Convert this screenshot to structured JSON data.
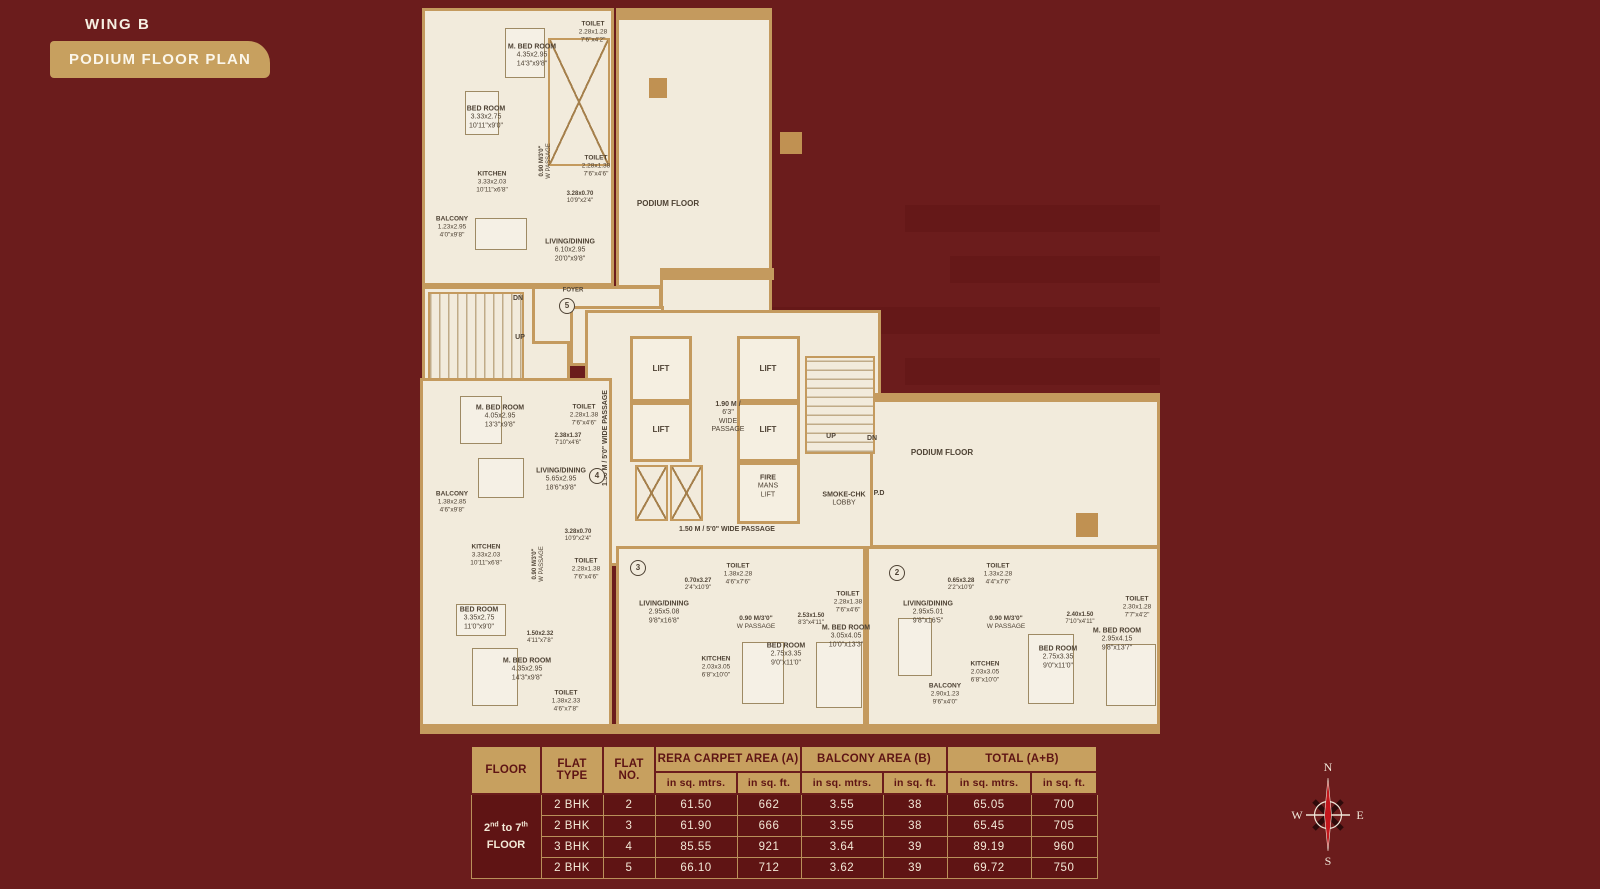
{
  "header": {
    "wing": "WING B",
    "badge": "PODIUM FLOOR PLAN"
  },
  "plan": {
    "labels": [
      {
        "id": "t5_toilet1",
        "lines": [
          "TOILET",
          "2.28x1.28",
          "7'6\"x4'2\""
        ]
      },
      {
        "id": "t5_mbed",
        "lines": [
          "M. BED ROOM",
          "4.35x2.95",
          "14'3\"x9'8\""
        ]
      },
      {
        "id": "t5_bed",
        "lines": [
          "BED ROOM",
          "3.33x2.75",
          "10'11\"x9'0\""
        ]
      },
      {
        "id": "t5_pass",
        "lines": [
          "0.90 M/3'0\"",
          "W PASSAGE"
        ]
      },
      {
        "id": "t5_toilet2",
        "lines": [
          "TOILET",
          "2.28x1.38",
          "7'6\"x4'6\""
        ]
      },
      {
        "id": "t5_kitchen",
        "lines": [
          "KITCHEN",
          "3.33x2.03",
          "10'11\"x6'8\""
        ]
      },
      {
        "id": "t5_dim1",
        "lines": [
          "3.28x0.70",
          "10'9\"x2'4\""
        ]
      },
      {
        "id": "t5_balcony",
        "lines": [
          "BALCONY",
          "1.23x2.95",
          "4'0\"x9'8\""
        ]
      },
      {
        "id": "t5_living",
        "lines": [
          "LIVING/DINING",
          "6.10x2.95",
          "20'0\"x9'8\""
        ]
      },
      {
        "id": "podium_top",
        "lines": [
          "PODIUM FLOOR"
        ]
      },
      {
        "id": "dn1",
        "lines": [
          "DN"
        ]
      },
      {
        "id": "up1",
        "lines": [
          "UP"
        ]
      },
      {
        "id": "foyer",
        "lines": [
          "FOYER"
        ]
      },
      {
        "id": "circ5",
        "circle": true,
        "lines": [
          "5"
        ]
      },
      {
        "id": "lift1",
        "lines": [
          "LIFT"
        ]
      },
      {
        "id": "lift2",
        "lines": [
          "LIFT"
        ]
      },
      {
        "id": "lift3",
        "lines": [
          "LIFT"
        ]
      },
      {
        "id": "lift4",
        "lines": [
          "LIFT"
        ]
      },
      {
        "id": "pass190",
        "lines": [
          "1.90 M /",
          "6'3\"",
          "WIDE",
          "PASSAGE"
        ]
      },
      {
        "id": "fire",
        "lines": [
          "FIRE",
          "MANS",
          "LIFT"
        ]
      },
      {
        "id": "smoke",
        "lines": [
          "SMOKE-CHK",
          "LOBBY"
        ]
      },
      {
        "id": "pd",
        "lines": [
          "P.D"
        ]
      },
      {
        "id": "up2",
        "lines": [
          "UP"
        ]
      },
      {
        "id": "dn2",
        "lines": [
          "DN"
        ]
      },
      {
        "id": "vpass",
        "lines": [
          "1.50 M / 5'0\"  WIDE PASSAGE"
        ]
      },
      {
        "id": "hpass",
        "lines": [
          "1.50 M / 5'0\"  WIDE PASSAGE"
        ]
      },
      {
        "id": "f4_mbed",
        "lines": [
          "M. BED ROOM",
          "4.05x2.95",
          "13'3\"x9'8\""
        ]
      },
      {
        "id": "f4_toilet1",
        "lines": [
          "TOILET",
          "2.28x1.38",
          "7'6\"x4'6\""
        ]
      },
      {
        "id": "f4_dim1",
        "lines": [
          "2.38x1.37",
          "7'10\"x4'6\""
        ]
      },
      {
        "id": "f4_living",
        "lines": [
          "LIVING/DINING",
          "5.65x2.95",
          "18'6\"x9'8\""
        ]
      },
      {
        "id": "f4_balcony",
        "lines": [
          "BALCONY",
          "1.38x2.85",
          "4'6\"x9'8\""
        ]
      },
      {
        "id": "circ4",
        "circle": true,
        "lines": [
          "4"
        ]
      },
      {
        "id": "f4_dim2",
        "lines": [
          "3.28x0.70",
          "10'9\"x2'4\""
        ]
      },
      {
        "id": "f4_kitchen",
        "lines": [
          "KITCHEN",
          "3.33x2.03",
          "10'11\"x6'8\""
        ]
      },
      {
        "id": "f4_pass",
        "lines": [
          "0.90 M/3'0\"",
          "W PASSAGE"
        ]
      },
      {
        "id": "f4_toilet2",
        "lines": [
          "TOILET",
          "2.28x1.38",
          "7'6\"x4'6\""
        ]
      },
      {
        "id": "f4_bed",
        "lines": [
          "BED ROOM",
          "3.35x2.75",
          "11'0\"x9'0\""
        ]
      },
      {
        "id": "f4_dim3",
        "lines": [
          "1.50x2.32",
          "4'11\"x7'8\""
        ]
      },
      {
        "id": "f4_mbed2",
        "lines": [
          "M. BED ROOM",
          "4.35x2.95",
          "14'3\"x9'8\""
        ]
      },
      {
        "id": "f4_toilet3",
        "lines": [
          "TOILET",
          "1.38x2.33",
          "4'6\"x7'8\""
        ]
      },
      {
        "id": "circ3",
        "circle": true,
        "lines": [
          "3"
        ]
      },
      {
        "id": "f3_living",
        "lines": [
          "LIVING/DINING",
          "2.95x5.08",
          "9'8\"x16'8\""
        ]
      },
      {
        "id": "f3_dim1",
        "lines": [
          "0.70x3.27",
          "2'4\"x10'9\""
        ]
      },
      {
        "id": "f3_toilet1",
        "lines": [
          "TOILET",
          "1.38x2.28",
          "4'6\"x7'6\""
        ]
      },
      {
        "id": "f3_pass",
        "lines": [
          "0.90 M/3'0\"",
          "W PASSAGE"
        ]
      },
      {
        "id": "f3_dim2",
        "lines": [
          "2.53x1.50",
          "8'3\"x4'11\""
        ]
      },
      {
        "id": "f3_toilet2",
        "lines": [
          "TOILET",
          "2.28x1.38",
          "7'6\"x4'6\""
        ]
      },
      {
        "id": "f3_kitchen",
        "lines": [
          "KITCHEN",
          "2.03x3.05",
          "6'8\"x10'0\""
        ]
      },
      {
        "id": "f3_bed",
        "lines": [
          "BED ROOM",
          "2.75x3.35",
          "9'0\"x11'0\""
        ]
      },
      {
        "id": "f3_mbed",
        "lines": [
          "M. BED ROOM",
          "3.05x4.05",
          "10'0\"x13'3\""
        ]
      },
      {
        "id": "circ2",
        "circle": true,
        "lines": [
          "2"
        ]
      },
      {
        "id": "f2_living",
        "lines": [
          "LIVING/DINING",
          "2.95x5.01",
          "9'8\"x16'5\""
        ]
      },
      {
        "id": "f2_dim1",
        "lines": [
          "0.65x3.28",
          "2'2\"x10'9\""
        ]
      },
      {
        "id": "f2_toilet1",
        "lines": [
          "TOILET",
          "1.33x2.28",
          "4'4\"x7'6\""
        ]
      },
      {
        "id": "f2_pass",
        "lines": [
          "0.90 M/3'0\"",
          "W PASSAGE"
        ]
      },
      {
        "id": "f2_dim2",
        "lines": [
          "2.40x1.50",
          "7'10\"x4'11\""
        ]
      },
      {
        "id": "f2_toilet2",
        "lines": [
          "TOILET",
          "2.30x1.28",
          "7'7\"x4'2\""
        ]
      },
      {
        "id": "f2_kitchen",
        "lines": [
          "KITCHEN",
          "2.03x3.05",
          "6'8\"x10'0\""
        ]
      },
      {
        "id": "f2_balcony",
        "lines": [
          "BALCONY",
          "2.90x1.23",
          "9'6\"x4'0\""
        ]
      },
      {
        "id": "f2_bed",
        "lines": [
          "BED ROOM",
          "2.75x3.35",
          "9'0\"x11'0\""
        ]
      },
      {
        "id": "f2_mbed",
        "lines": [
          "M. BED ROOM",
          "2.95x4.15",
          "9'8\"x13'7\""
        ]
      },
      {
        "id": "podium_right",
        "lines": [
          "PODIUM FLOOR"
        ]
      }
    ]
  },
  "table": {
    "headers": {
      "floor": "FLOOR",
      "flat_type": "FLAT TYPE",
      "flat_no": "FLAT NO.",
      "rera": "RERA CARPET AREA (A)",
      "balcony": "BALCONY AREA (B)",
      "total": "TOTAL (A+B)",
      "sqm": "in sq. mtrs.",
      "sqft": "in sq. ft."
    },
    "floor_cell": {
      "n1": "2",
      "s1": "nd",
      "mid": " to ",
      "n2": "7",
      "s2": "th",
      "line2": "FLOOR"
    },
    "rows": [
      {
        "type": "2 BHK",
        "no": "2",
        "vals": [
          "61.50",
          "662",
          "3.55",
          "38",
          "65.05",
          "700"
        ]
      },
      {
        "type": "2 BHK",
        "no": "3",
        "vals": [
          "61.90",
          "666",
          "3.55",
          "38",
          "65.45",
          "705"
        ]
      },
      {
        "type": "3 BHK",
        "no": "4",
        "vals": [
          "85.55",
          "921",
          "3.64",
          "39",
          "89.19",
          "960"
        ]
      },
      {
        "type": "2 BHK",
        "no": "5",
        "vals": [
          "66.10",
          "712",
          "3.62",
          "39",
          "69.72",
          "750"
        ]
      }
    ]
  },
  "compass": {
    "n": "N",
    "e": "E",
    "s": "S",
    "w": "W"
  }
}
